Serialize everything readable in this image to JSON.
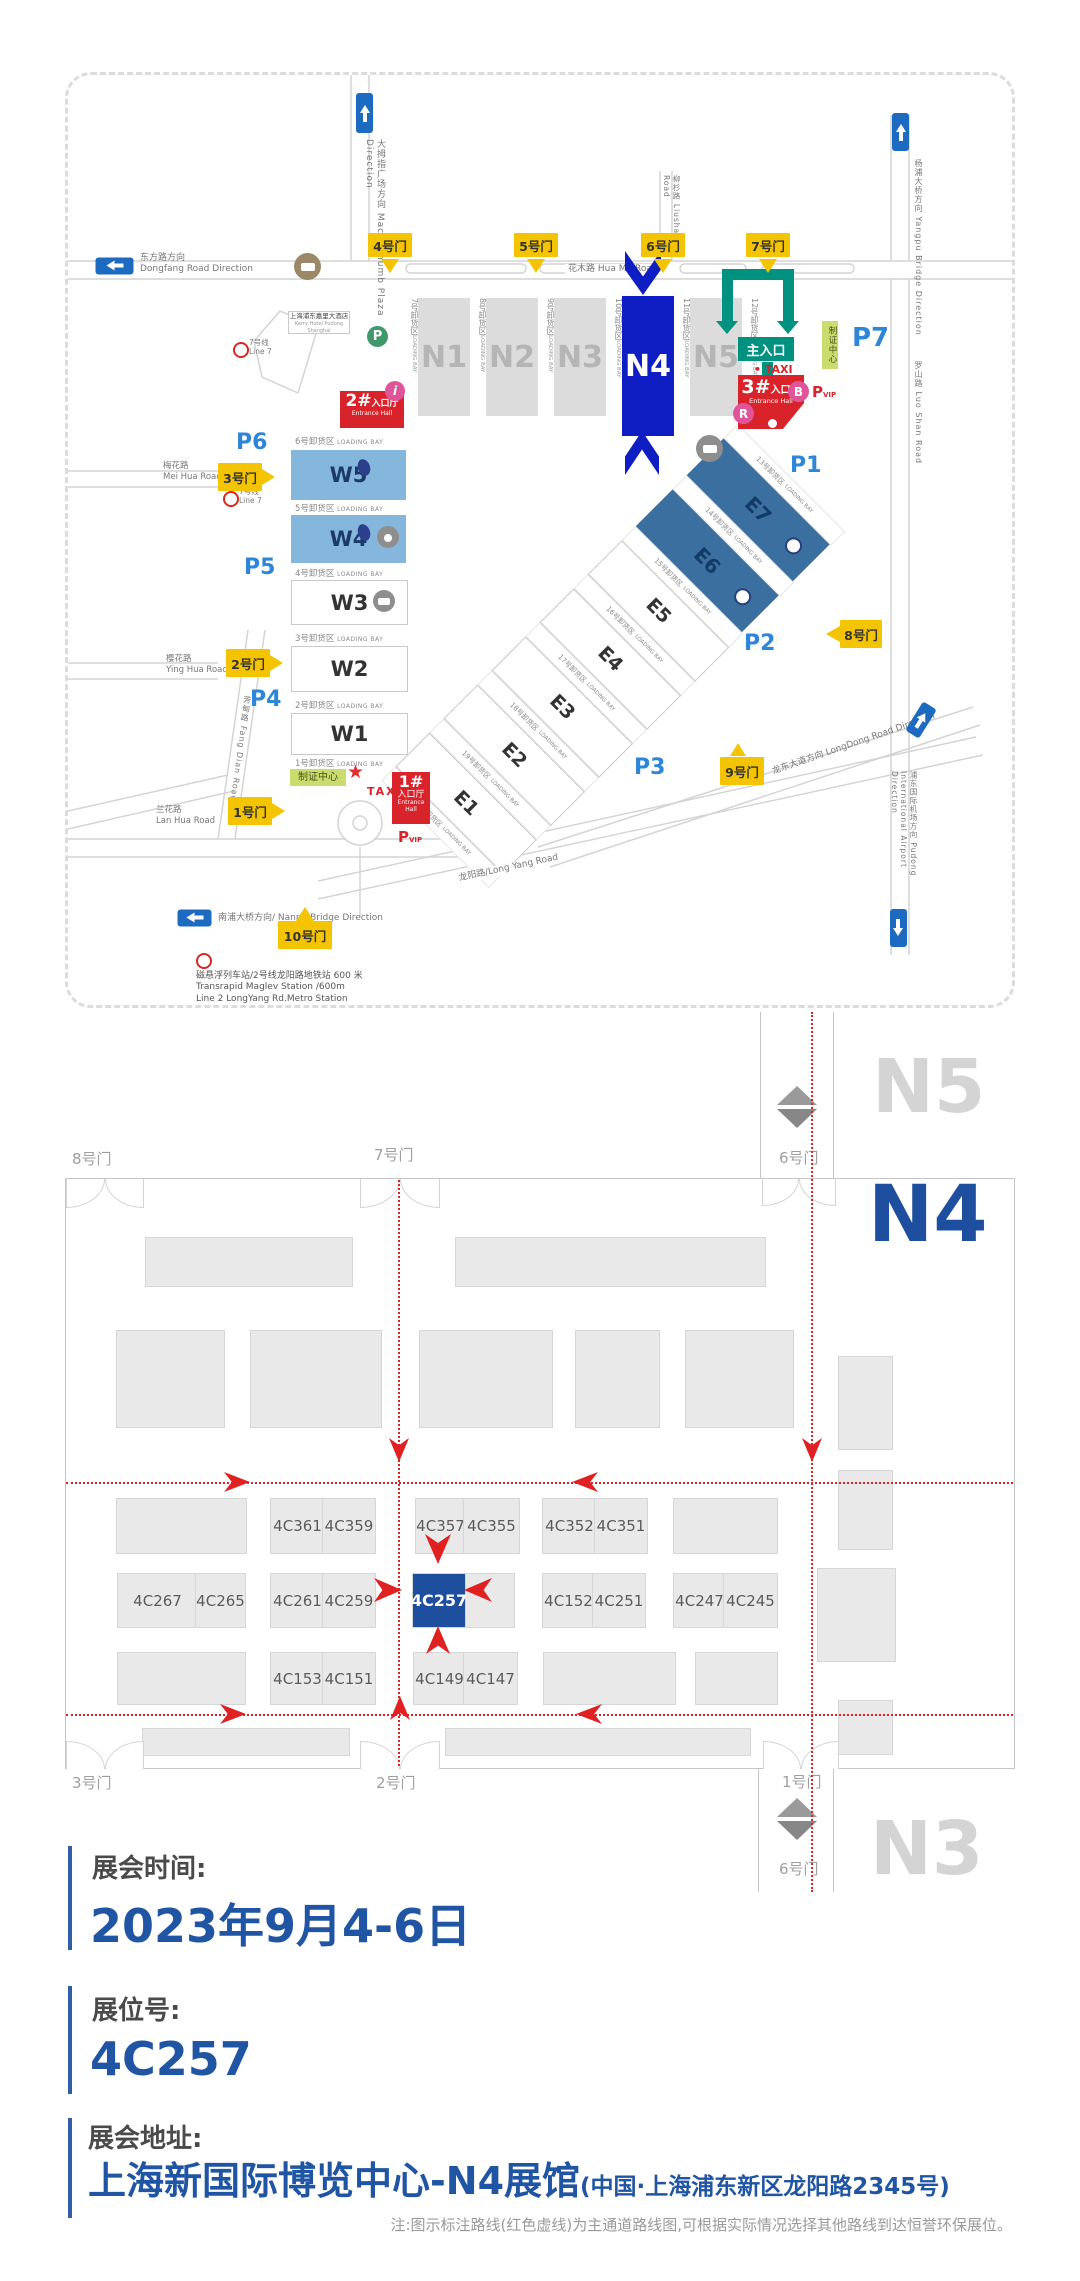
{
  "venue_map": {
    "roads": {
      "macro_thumb": "大拇指广场方向 Macro-thumb Plaza Direction",
      "dongfang_zh": "东方路方向",
      "dongfang_en": "Dongfang Road Direction",
      "huamu": "花木路 Hua Mu Road",
      "liushan": "柳杉路 Liushan Road",
      "yangpu": "杨浦大桥方向 Yangpu Bridge Direction",
      "luoshan": "罗山路 Luo Shan Road",
      "meihua_zh": "梅花路",
      "meihua_en": "Mei Hua Road",
      "yinghua_zh": "樱花路",
      "yinghua_en": "Ying Hua Road",
      "fangdian": "芳甸路 Fang Dian Road",
      "lanhua_zh": "兰花路",
      "lanhua_en": "Lan Hua Road",
      "nanpu": "南浦大桥方向/ Nanpu Bridge Direction",
      "longyang": "龙阳路/Long Yang Road",
      "longdong": "龙东大道方向 LongDong Road Direction",
      "airport": "浦东国际机场方向 Pudong International Airport Direction"
    },
    "gates": {
      "g1": "1号门",
      "g2": "2号门",
      "g3": "3号门",
      "g4": "4号门",
      "g5": "5号门",
      "g6": "6号门",
      "g7": "7号门",
      "g8": "8号门",
      "g9": "9号门",
      "g10": "10号门"
    },
    "halls": {
      "n1": "N1",
      "n2": "N2",
      "n3": "N3",
      "n4": "N4",
      "n5": "N5",
      "w1": "W1",
      "w2": "W2",
      "w3": "W3",
      "w4": "W4",
      "w5": "W5",
      "e1": "E1",
      "e2": "E2",
      "e3": "E3",
      "e4": "E4",
      "e5": "E5",
      "e6": "E6",
      "e7": "E7"
    },
    "parking": {
      "p1": "P1",
      "p2": "P2",
      "p3": "P3",
      "p4": "P4",
      "p5": "P5",
      "p6": "P6",
      "p7": "P7",
      "p": "P",
      "pvip_p": "P",
      "pvip_sub": "VIP"
    },
    "bays": {
      "en": "LOADING BAY",
      "b1": "1号卸货区",
      "b2": "2号卸货区",
      "b3": "3号卸货区",
      "b4": "4号卸货区",
      "b5": "5号卸货区",
      "b6": "6号卸货区",
      "b7": "7号卸货区",
      "b8": "8号卸货区",
      "b9": "9号卸货区",
      "b10": "10号卸货区",
      "b11": "11号卸货区",
      "b12": "12号卸货区",
      "b13": "13号卸货区",
      "b14": "14号卸货区",
      "b15": "15号卸货区",
      "b16": "16号卸货区",
      "b17": "17号卸货区",
      "b18": "18号卸货区",
      "b19": "19号卸货区",
      "b20": "20号卸货区"
    },
    "entrances": {
      "main": "主入口",
      "num1": "1#",
      "num2": "2#",
      "num3": "3#",
      "hall_zh": "入口厅",
      "hall_en": "Entrance Hall",
      "badge_center": "制证中心",
      "taxi": "TAXI",
      "taxi_dot": "• TAXI",
      "star": "★",
      "info_i": "i",
      "b": "B",
      "r": "R"
    },
    "hotel": {
      "zh": "上海浦东嘉里大酒店",
      "en": "Kerry Hotel Pudong Shanghai"
    },
    "metro": {
      "line7_zh": "7号线",
      "line7_en": "Line 7",
      "note1": "磁悬浮列车站/2号线龙阳路地铁站 600 米",
      "note2": "Transrapid Maglev Station  /600m",
      "note3": "Line 2 LongYang Rd.Metro Station"
    }
  },
  "floor_plan": {
    "halls": {
      "n5": "N5",
      "n4": "N4",
      "n3": "N3"
    },
    "gates": {
      "g8": "8号门",
      "g7": "7号门",
      "g6_top": "6号门",
      "g3": "3号门",
      "g2": "2号门",
      "g1": "1号门",
      "g6_bottom": "6号门"
    },
    "booths": {
      "row1": [
        "4C361",
        "4C359",
        "4C357",
        "4C355",
        "4C352",
        "4C351"
      ],
      "row2": [
        "4C267",
        "4C265",
        "4C261",
        "4C259",
        "4C257",
        "4C152",
        "4C251",
        "4C247",
        "4C245"
      ],
      "row3": [
        "4C153",
        "4C151",
        "4C149",
        "4C147"
      ],
      "highlighted": "4C257"
    }
  },
  "info": {
    "time_label": "展会时间:",
    "time_value": "2023年9月4-6日",
    "booth_label": "展位号:",
    "booth_value": "4C257",
    "addr_label": "展会地址:",
    "addr_main": "上海新国际博览中心-N4展馆",
    "addr_paren": "(中国·上海浦东新区龙阳路2345号)",
    "note": "注:图示标注路线(红色虚线)为主通道路线图,可根据实际情况选择其他路线到达恒誉环保展位。"
  },
  "colors": {
    "accent_blue": "#1F55A3",
    "hall_blue": "#0E1EC2",
    "booth_blue": "#1E4F9F",
    "light_blue": "#85B6DC",
    "steel_blue": "#3B6FA0",
    "teal": "#009180",
    "red": "#D8232A",
    "route_red": "#E02121",
    "gate_yellow": "#F5C400",
    "parking_blue": "#2E86D9",
    "badge_green": "#CBDC6E"
  }
}
